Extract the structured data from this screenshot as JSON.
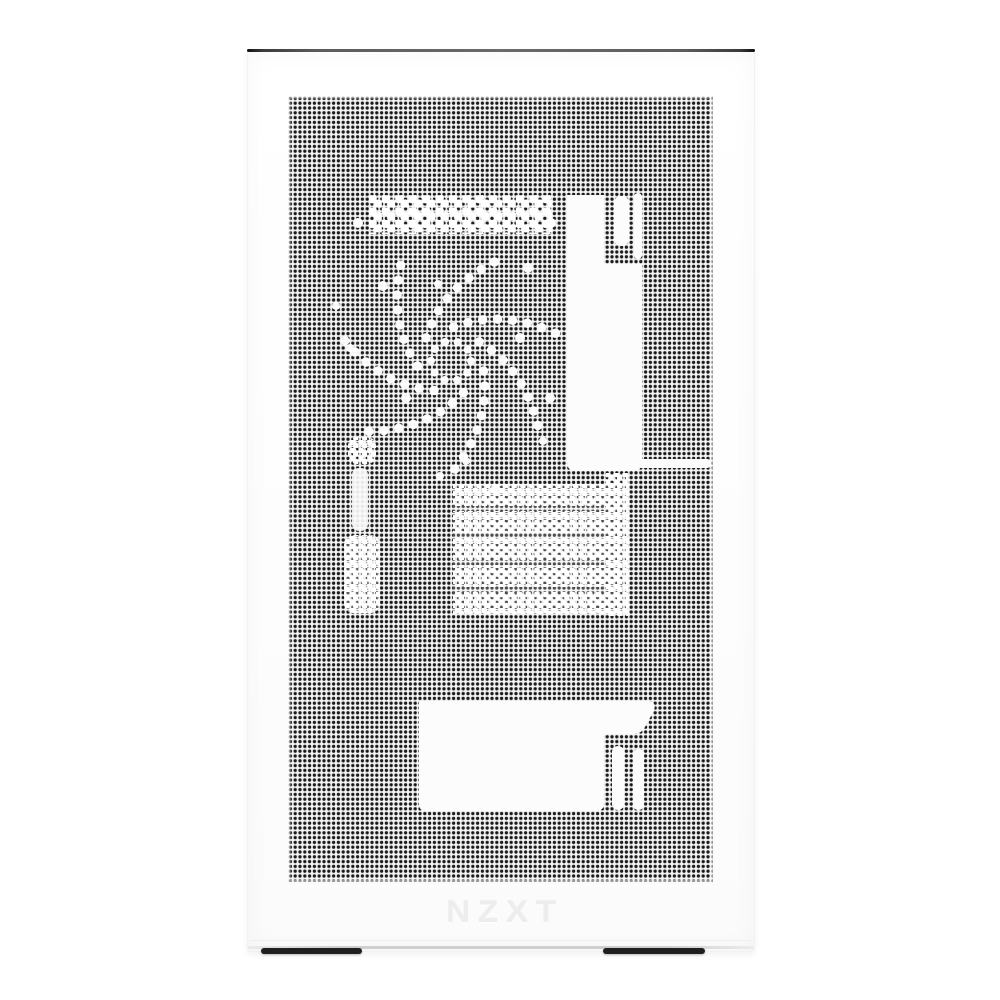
{
  "photo": {
    "description": "White NZXT small-form-factor PC case, front-facing product photo; perforated mesh side panel revealing white silhouettes of a cooling fan, rear I/O shroud, RAM heatsink fins and GPU/PSU block; embossed brand logo near the bottom; dark top edge trim and two dark feet.",
    "brand_logo_text": "NZXT",
    "colors": {
      "background": "#ffffff",
      "case_body": "#ffffff",
      "mesh_base": "#f3f3f3",
      "mesh_dot": "#1b1b1b",
      "top_edge_dark": "#3a3a3a",
      "bottom_edge": "#cfcfcf",
      "feet": "#1f1f1f",
      "logo_emboss": "#ededed",
      "silhouette_white": "#fcfcfc"
    }
  }
}
